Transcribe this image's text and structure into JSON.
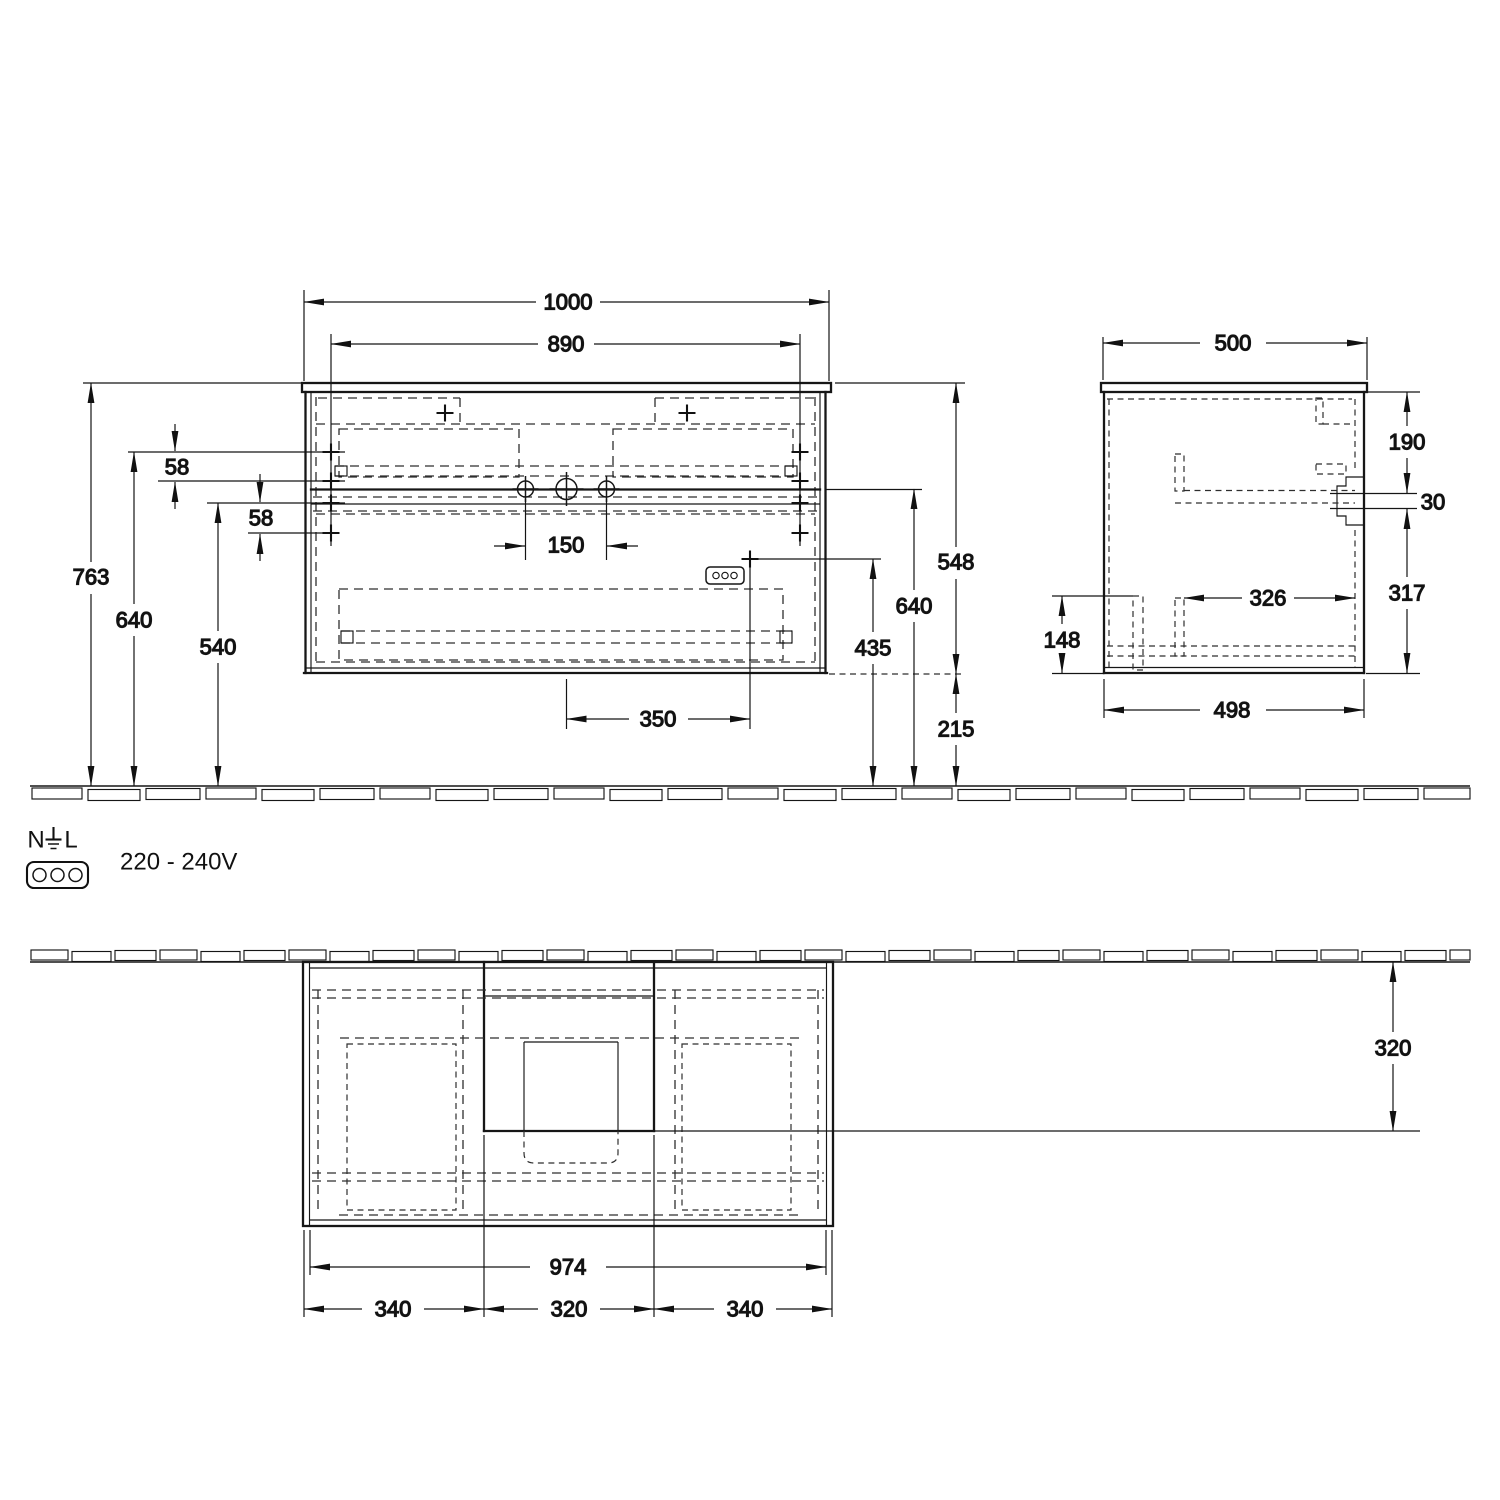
{
  "front_view": {
    "width_total": "1000",
    "width_mounting": "890",
    "offset_top": "58",
    "offset_bottom": "58",
    "height_total": "763",
    "height_upper_fix": "640",
    "height_lower_fix": "540",
    "tap_spacing": "150",
    "socket_offset": "350",
    "cabinet_height": "548",
    "height_worktop_ref": "640",
    "socket_height": "435",
    "clearance_bottom": "215"
  },
  "side_view": {
    "depth_total": "500",
    "recess_top": "190",
    "recess_gap": "30",
    "recess_bottom": "317",
    "inner_depth": "326",
    "back_cutout_height": "148",
    "depth_body": "498"
  },
  "plan_view": {
    "basin_depth": "320",
    "width_body": "974",
    "segment_left": "340",
    "segment_center": "320",
    "segment_right": "340"
  },
  "electrical": {
    "neutral_label": "N",
    "live_label": "L",
    "voltage": "220 - 240V",
    "socket_icon": "three-pin-socket-icon",
    "earth_icon": "earth-ground-icon"
  }
}
